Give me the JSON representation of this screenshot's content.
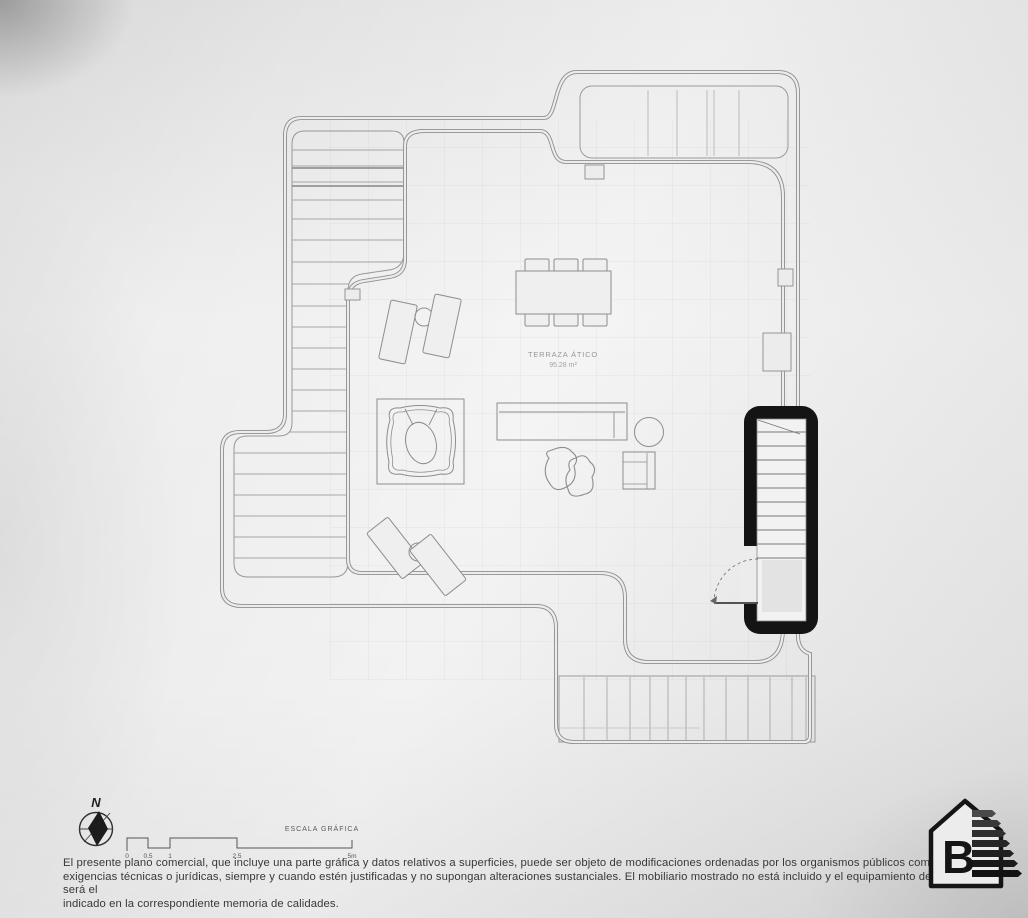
{
  "plan": {
    "room_label": "TERRAZA ÁTICO",
    "room_area": "95.28 m²"
  },
  "compass": {
    "north_label": "N"
  },
  "scale_bar": {
    "title": "ESCALA GRÁFICA",
    "ticks": [
      "0",
      "0.5",
      "1",
      "2.5",
      "5m"
    ]
  },
  "disclaimer": {
    "line1": "El presente plano comercial, que incluye una parte gráfica y datos relativos a superficies, puede ser objeto de modificaciones ordenadas por los organismos públicos competentes y/o",
    "line2": "exigencias técnicas o jurídicas, siempre y cuando estén justificadas y no supongan alteraciones sustanciales. El mobiliario mostrado no está incluido y el equipamiento del inmueble será el",
    "line3": "indicado en la correspondiente memoria de calidades."
  },
  "energy_label": {
    "rating": "B"
  },
  "colors": {
    "line": "#8f8f8f",
    "ink": "#1a1a1a",
    "paper": "#ececec"
  }
}
